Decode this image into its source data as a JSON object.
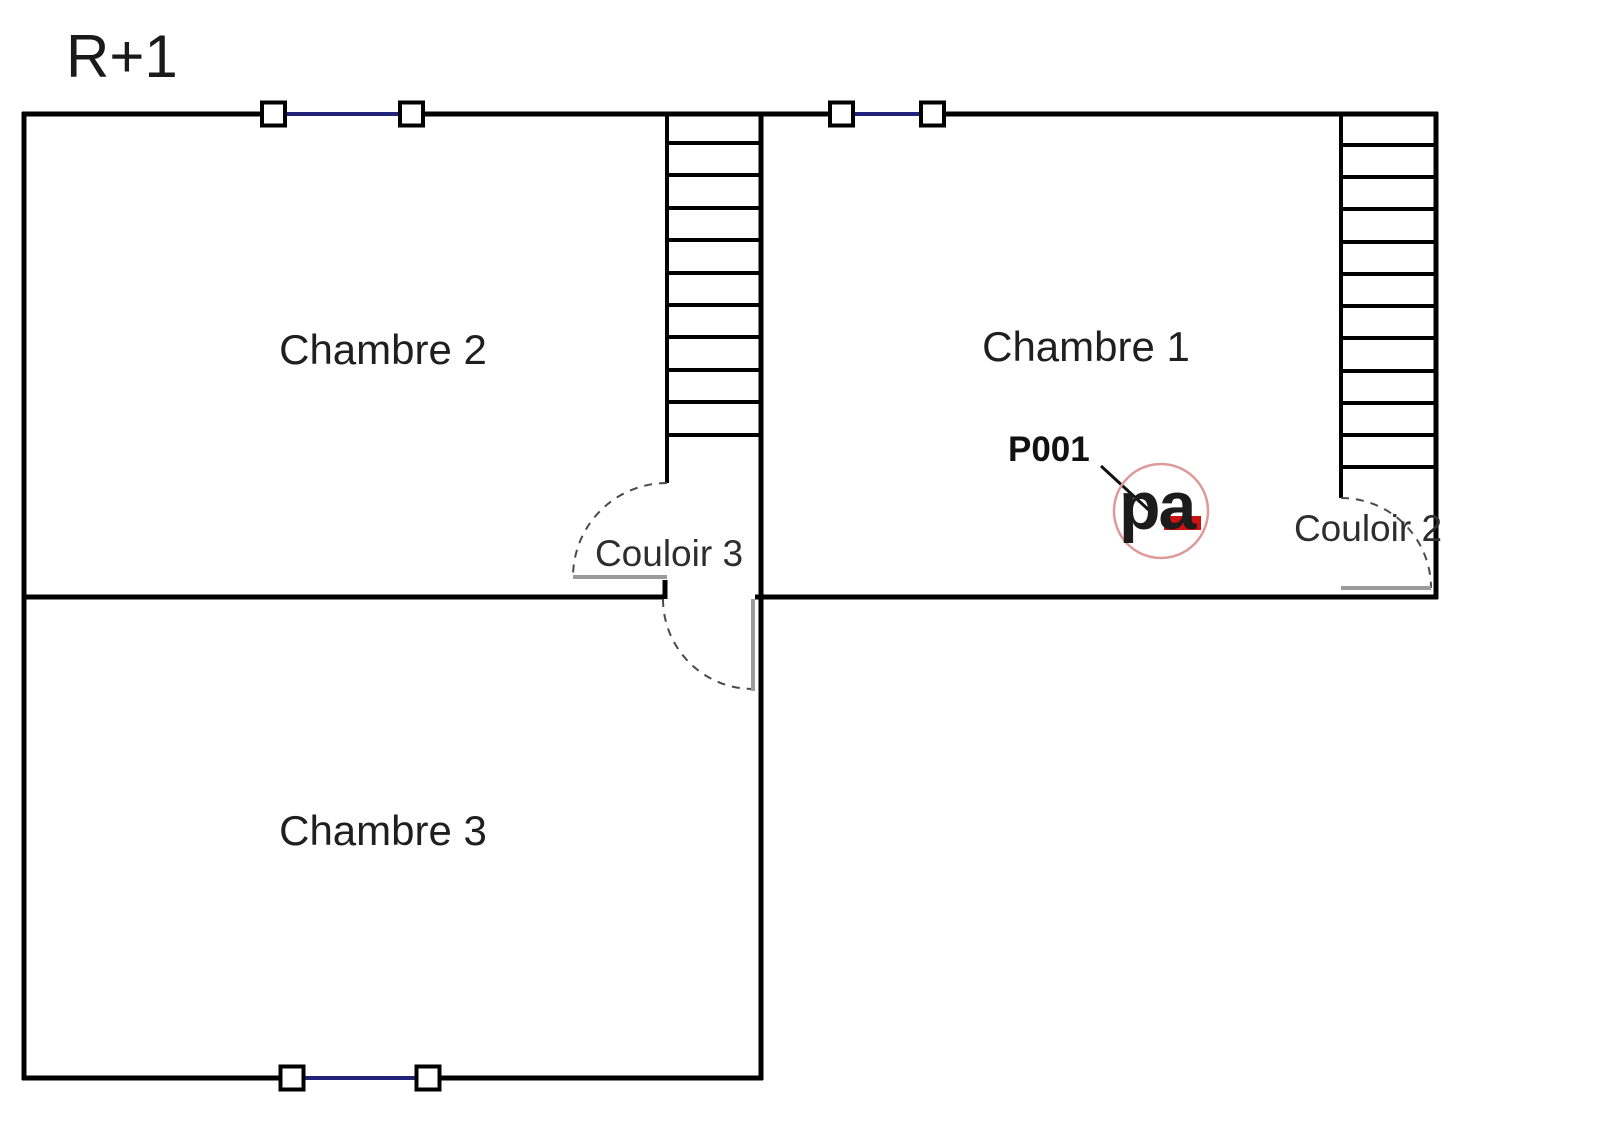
{
  "title": "R+1",
  "rooms": {
    "chambre1": {
      "label": "Chambre 1"
    },
    "chambre2": {
      "label": "Chambre 2"
    },
    "chambre3": {
      "label": "Chambre 3"
    },
    "couloir3": {
      "label": "Couloir 3"
    },
    "couloir2": {
      "label": "Couloir 2"
    }
  },
  "door_tag": {
    "label": "P001"
  },
  "logo": {
    "text": "pa"
  },
  "colors": {
    "wall": "#000000",
    "window_glass": "#22227a",
    "door_leaf": "#9b9b9b",
    "door_swing": "#4a4a4a",
    "logo_circle": "#de9a9a",
    "logo_accent": "#cc1111",
    "text": "#1f1f1f"
  }
}
